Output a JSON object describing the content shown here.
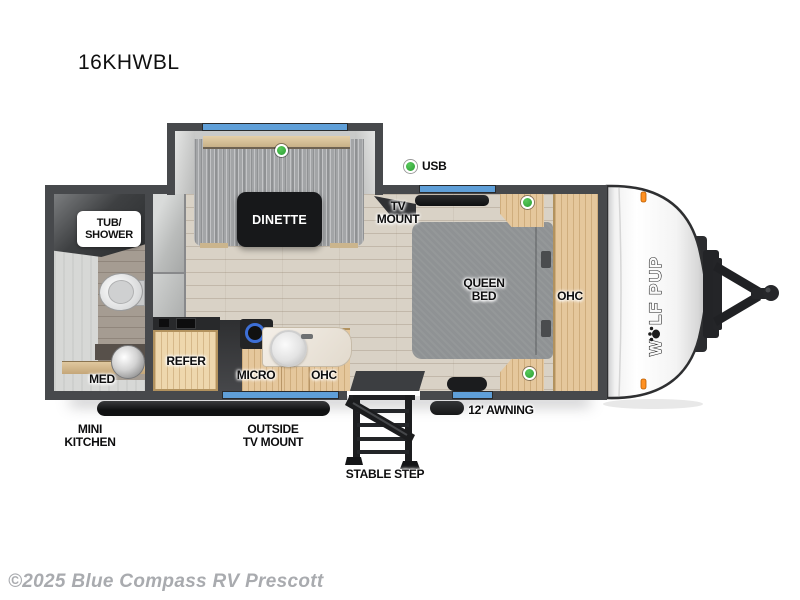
{
  "page": {
    "title": "16KHWBL",
    "watermark": "©2025 Blue Compass RV Prescott"
  },
  "floorplan": {
    "model": "16KHWBL",
    "labels": {
      "dinette": "DINETTE",
      "usb": "USB",
      "tv_mount_l1": "TV",
      "tv_mount_l2": "MOUNT",
      "queen_bed_l1": "QUEEN",
      "queen_bed_l2": "BED",
      "ohc_bed": "OHC",
      "tub_shower_l1": "TUB/",
      "tub_shower_l2": "SHOWER",
      "med": "MED",
      "refer": "REFER",
      "micro": "MICRO",
      "ohc_kitchen": "OHC",
      "mini_kitchen_l1": "MINI",
      "mini_kitchen_l2": "KITCHEN",
      "outside_tv_mount_l1": "OUTSIDE",
      "outside_tv_mount_l2": "TV MOUNT",
      "awning": "12' AWNING",
      "stable_step": "STABLE STEP"
    },
    "brand": {
      "logo_w": "W",
      "logo_rest": "LF PUP"
    },
    "colors": {
      "wall_gray": "#47494c",
      "window_blue": "#5f9fd8",
      "usb_green": "#2fae36",
      "wood_cabinet": "#e5c79c",
      "floor_wood": "#d9d2c6",
      "cushion_gray": "#9fa1a3",
      "table_black": "#17181a"
    }
  }
}
